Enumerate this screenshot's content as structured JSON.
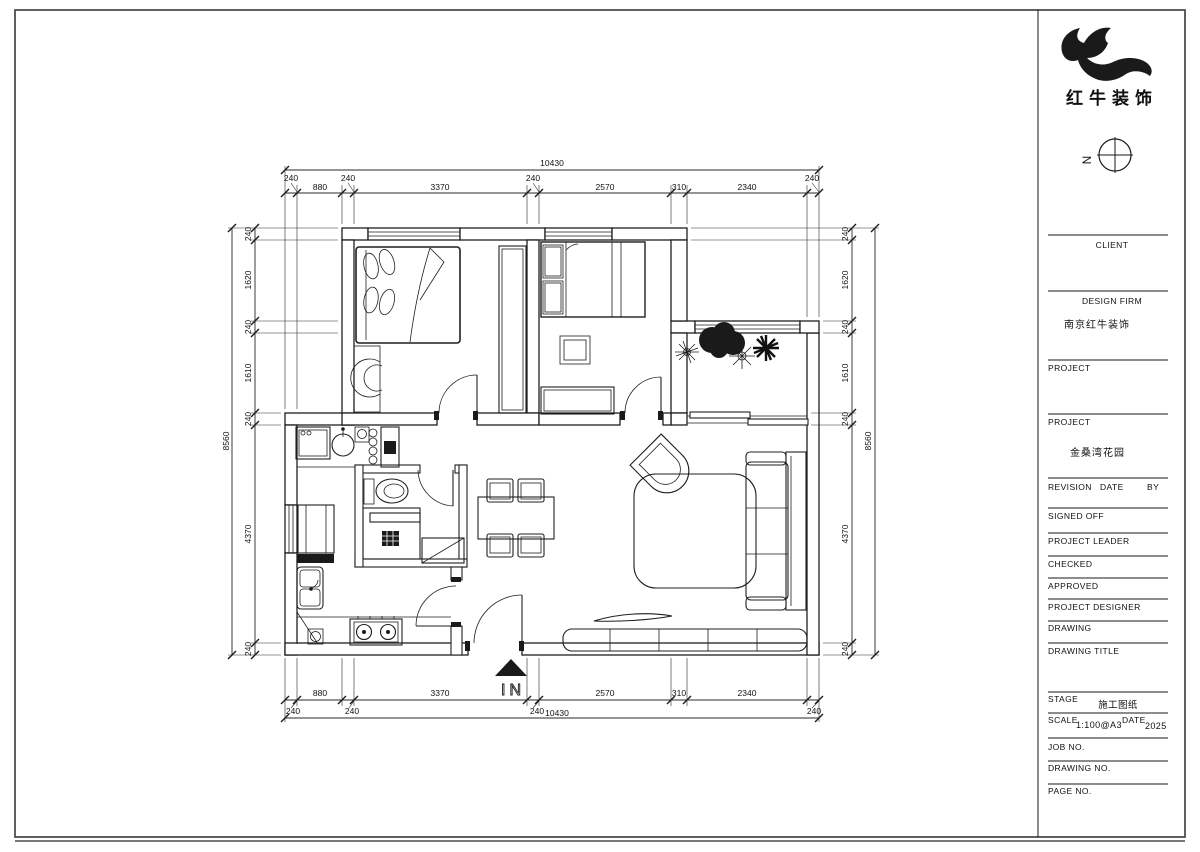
{
  "logo": {
    "company_name": "红牛装饰"
  },
  "north_label": "N",
  "plan": {
    "entrance_label": "IN",
    "dims": {
      "top_overall": "10430",
      "top_chain": [
        "240",
        "880",
        "240",
        "3370",
        "240",
        "2570",
        "310",
        "2340",
        "240"
      ],
      "bottom_chain": [
        "880",
        "3370",
        "2570",
        "310",
        "2340"
      ],
      "bottom_offsets": [
        "240",
        "240",
        "240",
        "240"
      ],
      "bottom_overall": "10430",
      "left_overall": "8560",
      "left_chain": [
        "240",
        "1620",
        "240",
        "1610",
        "240",
        "4370",
        "240"
      ],
      "right_overall": "8560",
      "right_chain": [
        "240",
        "1620",
        "240",
        "1610",
        "240",
        "4370",
        "240"
      ]
    }
  },
  "title_block": {
    "client_label": "CLIENT",
    "design_firm_label": "DESIGN FIRM",
    "design_firm_value": "南京红牛装饰",
    "project1_label": "PROJECT",
    "project2_label": "PROJECT",
    "project2_value": "金桑湾花园",
    "revision_label": "REVISION",
    "date_label": "DATE",
    "by_label": "BY",
    "signed_off_label": "SIGNED OFF",
    "project_leader_label": "PROJECT LEADER",
    "checked_label": "CHECKED",
    "approved_label": "APPROVED",
    "project_designer_label": "PROJECT DESIGNER",
    "drawing_label": "DRAWING",
    "drawing_title_label": "DRAWING TITLE",
    "stage_label": "STAGE",
    "stage_value": "施工图纸",
    "scale_label": "SCALE",
    "scale_value": "1:100@A3",
    "date2_label": "DATE",
    "date_value": "2025",
    "job_no_label": "JOB NO.",
    "drawing_no_label": "DRAWING NO.",
    "page_no_label": "PAGE NO."
  }
}
